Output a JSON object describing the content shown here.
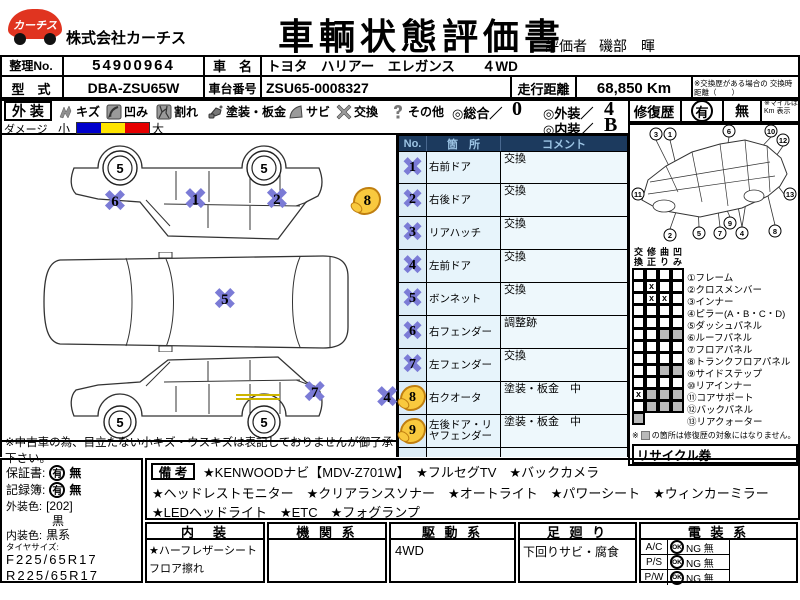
{
  "header": {
    "logo_text": "カーチス",
    "company": "株式会社カーチス",
    "title": "車輌状態評価書",
    "evaluator_label": "評価者",
    "evaluator_name": "磯部　暉"
  },
  "info": {
    "ref_label": "整理No.",
    "ref_value": "54900964",
    "car_name_label": "車　名",
    "car_name_value": "トヨタ　ハリアー　エレガンス　　４WD",
    "model_label": "型　式",
    "model_value": "DBA-ZSU65W",
    "chassis_label": "車台番号",
    "chassis_value": "ZSU65-0008327",
    "mileage_label": "走行距離",
    "mileage_value": "68,850 Km",
    "mileage_note": "※交換歴がある場合の 交換時距離（　　）"
  },
  "legend": {
    "section_label": "外 装",
    "items": [
      {
        "icon": "scratch-icon",
        "label": "キズ"
      },
      {
        "icon": "dent-icon",
        "label": "凹み"
      },
      {
        "icon": "crack-icon",
        "label": "割れ"
      },
      {
        "icon": "paint-icon",
        "label": "塗装・板金"
      },
      {
        "icon": "rust-icon",
        "label": "サビ"
      },
      {
        "icon": "replace-icon",
        "label": "交換"
      },
      {
        "icon": "other-icon",
        "label": "その他"
      }
    ],
    "damage_label": "ダメージ",
    "damage_small": "小",
    "damage_large": "大",
    "scores": {
      "overall_label": "◎総合／",
      "overall": "0",
      "exterior_label": "◎外装／",
      "exterior": "4",
      "interior_label": "◎内装／",
      "interior": "B"
    }
  },
  "repair_history": {
    "label": "修復歴",
    "yes": "有",
    "no": "無",
    "note": "※マイルは Km 表示"
  },
  "parts_table": {
    "headers": [
      "No.",
      "箇　所",
      "コメント"
    ],
    "rows": [
      {
        "no": "1",
        "type": "x",
        "part": "右前ドア",
        "comment": "交換"
      },
      {
        "no": "2",
        "type": "x",
        "part": "右後ドア",
        "comment": "交換"
      },
      {
        "no": "3",
        "type": "x",
        "part": "リアハッチ",
        "comment": "交換"
      },
      {
        "no": "4",
        "type": "x",
        "part": "左前ドア",
        "comment": "交換"
      },
      {
        "no": "5",
        "type": "x",
        "part": "ボンネット",
        "comment": "交換"
      },
      {
        "no": "6",
        "type": "x",
        "part": "右フェンダー",
        "comment": "調整跡"
      },
      {
        "no": "7",
        "type": "x",
        "part": "左フェンダー",
        "comment": "交換"
      },
      {
        "no": "8",
        "type": "paint",
        "part": "右クオータ",
        "comment": "塗装・板金　中"
      },
      {
        "no": "9",
        "type": "paint",
        "part": "左後ドア・リヤフェンダー",
        "comment": "塗装・板金　中"
      },
      {
        "no": "",
        "type": "",
        "part": "",
        "comment": ""
      }
    ]
  },
  "frame_diagram": {
    "labels": [
      "3",
      "1",
      "6",
      "10",
      "12",
      "11",
      "2",
      "5",
      "7",
      "9",
      "4",
      "8",
      "13"
    ]
  },
  "frame_section": {
    "col_headers": [
      "交換",
      "修正",
      "曲り",
      "凹み"
    ],
    "rows": [
      {
        "name": "①フレーム",
        "cells": [
          "",
          "",
          "",
          ""
        ]
      },
      {
        "name": "②クロスメンバー",
        "cells": [
          "",
          "x",
          "",
          ""
        ]
      },
      {
        "name": "③インナー",
        "cells": [
          "",
          "x",
          "x",
          ""
        ]
      },
      {
        "name": "④ピラー(A・B・C・D)",
        "cells": [
          "",
          "",
          "",
          ""
        ]
      },
      {
        "name": "⑤ダッシュパネル",
        "cells": [
          "",
          "",
          "",
          ""
        ]
      },
      {
        "name": "⑥ルーフパネル",
        "cells": [
          "",
          "",
          "g",
          "g"
        ]
      },
      {
        "name": "⑦フロアパネル",
        "cells": [
          "",
          "",
          "",
          ""
        ]
      },
      {
        "name": "⑧トランクフロアパネル",
        "cells": [
          "",
          "",
          "",
          ""
        ]
      },
      {
        "name": "⑨サイドステップ",
        "cells": [
          "",
          "",
          "g",
          "g"
        ]
      },
      {
        "name": "⑩リアインナー",
        "cells": [
          "",
          "",
          "",
          ""
        ]
      },
      {
        "name": "⑪コアサポート",
        "cells": [
          "x",
          "g",
          "g",
          "g"
        ]
      },
      {
        "name": "⑫バックパネル",
        "cells": [
          "",
          "g",
          "g",
          "g"
        ]
      },
      {
        "name": "⑬リアクォーター",
        "cells": [
          "g"
        ]
      }
    ],
    "note_prefix": "※",
    "note": "の箇所は修復歴の対象にはなりません。",
    "recycle_label": "リサイクル券"
  },
  "diagrams": {
    "wheel_label": "5",
    "side_right_markers": [
      {
        "n": "6",
        "type": "x"
      },
      {
        "n": "1",
        "type": "x"
      },
      {
        "n": "2",
        "type": "x"
      },
      {
        "n": "8",
        "type": "paint"
      }
    ],
    "top_markers": [
      {
        "n": "5",
        "type": "x"
      },
      {
        "n": "3",
        "type": "x"
      }
    ],
    "side_left_markers": [
      {
        "n": "7",
        "type": "x"
      },
      {
        "n": "4",
        "type": "x"
      },
      {
        "n": "9",
        "type": "paint"
      }
    ]
  },
  "diagram_note": "※中古車の為、目立たない小キズ・ウスキズは表記しておりませんが御了承下さい。",
  "bottom_left": {
    "warranty_label": "保証書:",
    "warranty_yes": "有",
    "warranty_no": "無",
    "record_label": "記録簿:",
    "record_yes": "有",
    "record_no": "無",
    "ext_color_label": "外装色:",
    "ext_color_code": "[202]",
    "ext_color": "黒",
    "int_color_label": "内装色:",
    "int_color": "黒系",
    "tire_label": "タイヤサイズ:",
    "tire_front": "F225/65R17",
    "tire_rear": "R225/65R17"
  },
  "remarks": {
    "label": "備 考",
    "line1": "★KENWOODナビ【MDV-Z701W】　★フルセグTV　★バックカメラ",
    "line2": "★ヘッドレストモニター　★クリアランスソナー　★オートライト　★パワーシート　★ウィンカーミラー",
    "line3": "★LEDヘッドライト　★ETC　★フォグランプ"
  },
  "bottom_boxes": {
    "interior": {
      "title": "内　装",
      "line1": "★ハーフレザーシート",
      "line2": "フロア擦れ"
    },
    "engine": {
      "title": "機 関 系",
      "content": ""
    },
    "drivetrain": {
      "title": "駆 動 系",
      "content": "4WD"
    },
    "suspension": {
      "title": "足 廻 り",
      "content": "下回りサビ・腐食"
    },
    "electrical": {
      "title": "電 装 系",
      "rows": [
        {
          "name": "A/C",
          "ok": "OK",
          "ng": "NG 無"
        },
        {
          "name": "P/S",
          "ok": "OK",
          "ng": "NG 無"
        },
        {
          "name": "P/W",
          "ok": "OK",
          "ng": "NG 無"
        }
      ]
    }
  },
  "colors": {
    "x_marker": "#7b7bd6",
    "paint_marker": "#f9c93e",
    "damage_small": "#0000cc",
    "damage_mid": "#ffe400",
    "damage_large": "#e60000",
    "table_header_bg": "#1c3a5e",
    "table_row_bg": "#e7f4fb",
    "logo_red": "#e03420"
  }
}
